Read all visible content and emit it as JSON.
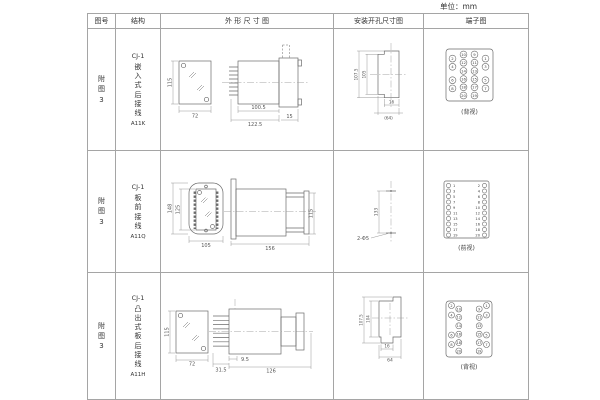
{
  "unit_label": "单位：mm",
  "headers": {
    "fig_no": "图号",
    "structure": "结构",
    "outline": "外 形 尺 寸 图",
    "install": "安装开孔尺寸图",
    "terminal": "端子图"
  },
  "rows": [
    {
      "fig_no": "附\n图\n3",
      "model": "CJ-1",
      "mount_type": "嵌\n入\n式\n后\n接\n线",
      "code": "A11K",
      "outline_dims": {
        "front_h": "115",
        "front_w": "72",
        "body_l": "100.5",
        "total_l": "122.5",
        "flange": "15"
      },
      "install_dims": {
        "outer_h": "107.5",
        "inner_h": "105",
        "slot_w": "16",
        "cutout_w": "(64)"
      },
      "terminal": {
        "view": "(背视)",
        "outer_left": [
          2,
          4,
          6,
          8
        ],
        "inner_left": [
          10,
          12,
          14,
          16,
          18,
          20
        ],
        "inner_right": [
          9,
          11,
          13,
          15,
          17,
          19
        ],
        "outer_right": [
          1,
          3,
          5,
          7
        ]
      }
    },
    {
      "fig_no": "附\n图\n3",
      "model": "CJ-1",
      "mount_type": "板\n前\n接\n线",
      "code": "A11Q",
      "outline_dims": {
        "front_h_outer": "148",
        "front_h_inner": "125",
        "front_w": "105",
        "side_l": "156",
        "side_h": "115"
      },
      "install_dims": {
        "hole_dist": "133",
        "hole_label": "2-Φ5"
      },
      "terminal": {
        "view": "(前视)",
        "left": [
          1,
          3,
          5,
          7,
          9,
          11,
          13,
          15,
          17,
          19
        ],
        "right": [
          2,
          4,
          6,
          8,
          10,
          12,
          14,
          16,
          18,
          20
        ]
      }
    },
    {
      "fig_no": "附\n图\n3",
      "model": "CJ-1",
      "mount_type": "凸\n出\n式\n板\n后\n接\n线",
      "code": "A11H",
      "outline_dims": {
        "front_h": "115",
        "front_w": "72",
        "pin_l": "9.5",
        "pin_total": "31.5",
        "body_l": "126"
      },
      "install_dims": {
        "outer_h": "107.5",
        "inner_h": "104",
        "slot_w": "16",
        "cutout_w": "64"
      },
      "terminal": {
        "view": "(背视)",
        "outer_left": [
          2,
          4,
          6,
          8
        ],
        "inner_left": [
          10,
          12,
          14,
          16,
          18,
          20
        ],
        "inner_right": [
          9,
          11,
          13,
          15,
          17,
          19
        ],
        "outer_right": [
          1,
          3,
          5,
          7
        ]
      }
    }
  ]
}
